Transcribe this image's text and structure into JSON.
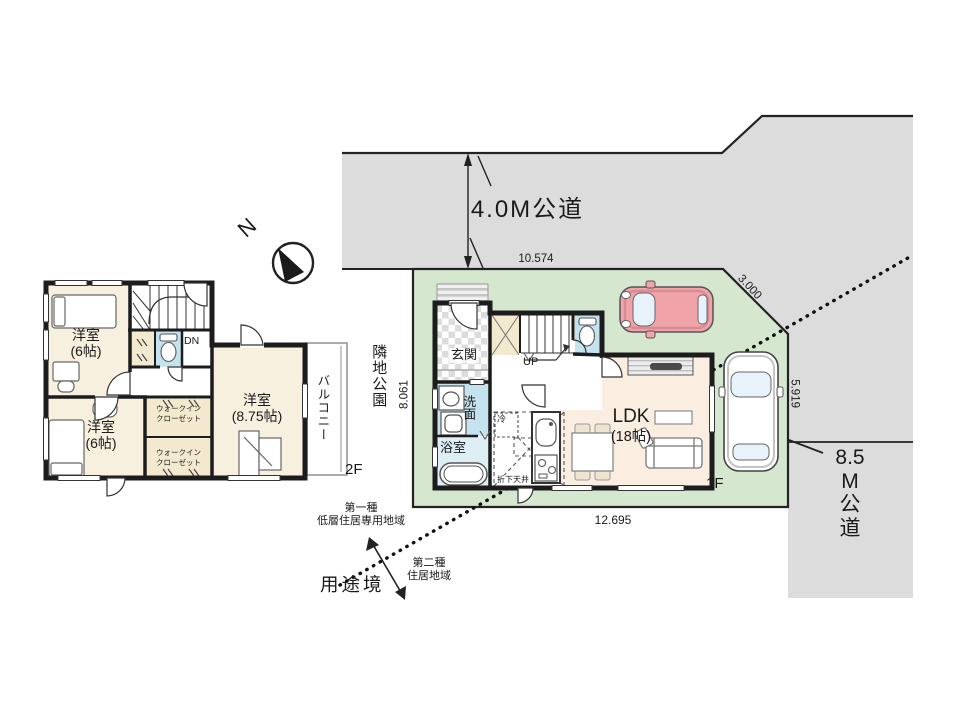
{
  "site": {
    "road_top_label": "4.0M公道",
    "road_right": {
      "l1": "8.5",
      "l2": "M",
      "l3": "公",
      "l4": "道"
    },
    "park_label": "隣地公園",
    "use_boundary_label": "用途境",
    "zone1": {
      "l1": "第一種",
      "l2": "低層住居専用地域"
    },
    "zone2": {
      "l1": "第二種",
      "l2": "住居地域"
    },
    "north_label": "N"
  },
  "dimensions": {
    "top": "10.574",
    "corner": "3.000",
    "right": "5.919",
    "left": "8.061",
    "bottom": "12.695"
  },
  "floor2": {
    "label": "2F",
    "bedroom1": {
      "name": "洋室",
      "size": "(6帖)"
    },
    "bedroom2": {
      "name": "洋室",
      "size": "(6帖)"
    },
    "bedroom3": {
      "name": "洋室",
      "size": "(8.75帖)"
    },
    "balcony_label": "バルコニー",
    "wic1": {
      "l1": "ウォークイン",
      "l2": "クローゼット"
    },
    "wic2": {
      "l1": "ウォークイン",
      "l2": "クローゼット"
    },
    "stair_label": "DN"
  },
  "floor1": {
    "label": "1F",
    "entrance_label": "玄関",
    "stair_label": "UP",
    "washroom_label": "洗面",
    "bath_label": "浴室",
    "ldk": {
      "name": "LDK",
      "size": "(18帖)"
    },
    "fridge_label": "冷",
    "dropped_ceiling_label": "折下天井"
  },
  "colors": {
    "road": "#dcdcdc",
    "lot": "#d6e7d0",
    "room": "#f8f0df",
    "ldk": "#faeee1",
    "wet": "#c5e3ee",
    "bath": "#ddeef5",
    "closet": "#f3e9cf",
    "car_red": "#f1a3aa",
    "car_window": "#e8f2fa",
    "wall": "#1c1c1c"
  }
}
